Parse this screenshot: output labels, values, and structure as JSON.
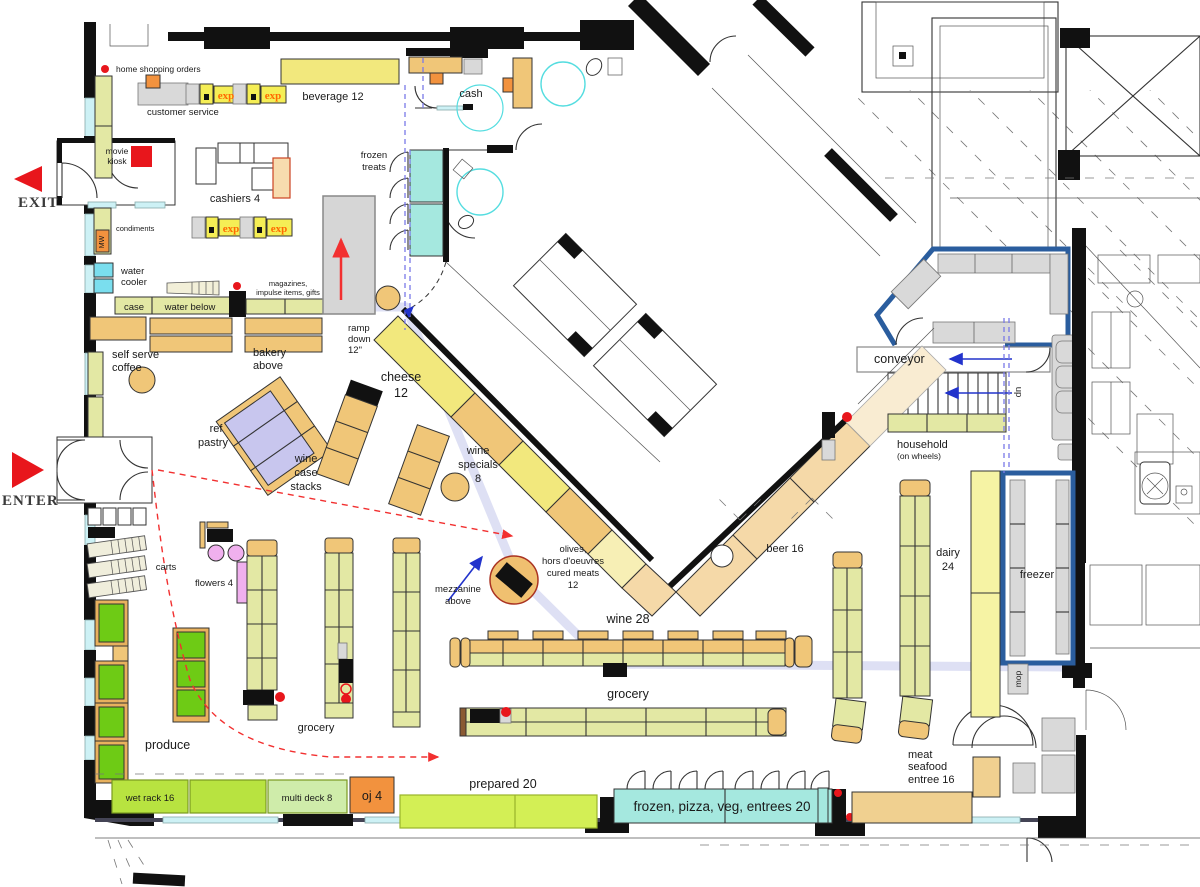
{
  "title": "grocery store floor plan",
  "colors": {
    "shelf_green": "#e3e8a4",
    "tan": "#f0c678",
    "beer_tan": "#f5d9a8",
    "yellow": "#f2e87d",
    "dairy_yellow": "#f6f3a4",
    "cyan_case": "#a5e8df",
    "window_cyan": "#cdf1f5",
    "produce_green": "#6ecb15",
    "wet_rack_green": "#b8e340",
    "multi_deck_green": "#cfecaa",
    "orange": "#f2923e",
    "lavender": "#c8c6ee",
    "pink": "#f0b0ee",
    "red": "#e8161c",
    "blue_wall": "#2a5d9e",
    "lease_line_blue": "#7a7ae8",
    "path_lavender": "#d3d6f0",
    "ramp_gray": "#d6d6d6",
    "exp_yellow": "#f5ee55",
    "exp_text_orange": "#ff6a00"
  },
  "labels": {
    "exit": "EXIT",
    "enter": "ENTER",
    "home_shopping_orders": "home shopping orders",
    "customer_service": "customer service",
    "exp": "exp",
    "beverage": "beverage 12",
    "cash": "cash",
    "movie_kiosk": [
      "movie",
      "kiosk"
    ],
    "cashiers": "cashiers 4",
    "frozen_treats": [
      "frozen",
      "treats"
    ],
    "condiments": "condiments",
    "mw": "MW",
    "water_cooler": [
      "water",
      "cooler"
    ],
    "case": "case",
    "water_below": "water below",
    "magazines": [
      "magazines,",
      "impulse items, gifts"
    ],
    "ramp": [
      "ramp",
      "down",
      "12\""
    ],
    "self_serve_coffee": [
      "self serve",
      "coffee"
    ],
    "bakery_above": [
      "bakery",
      "above"
    ],
    "ref_pastry": [
      "ref",
      "pastry"
    ],
    "wine_case_stacks": [
      "wine",
      "case",
      "stacks"
    ],
    "cheese": [
      "cheese",
      "12"
    ],
    "wine_specials": [
      "wine",
      "specials",
      "8"
    ],
    "carts": "carts",
    "flowers": "flowers 4",
    "olives": [
      "olives,",
      "hors d'oeuvres",
      "cured meats",
      "12"
    ],
    "mezzanine": [
      "mezzanine",
      "above"
    ],
    "conveyor": "conveyor",
    "up": "up",
    "household": [
      "household",
      "(on wheels)"
    ],
    "beer": "beer 16",
    "dairy": [
      "dairy",
      "24"
    ],
    "freezer": "freezer",
    "mop": "mop",
    "wine_run": "wine 28",
    "grocery_run": "grocery",
    "grocery_aisles": "grocery",
    "produce": "produce",
    "wet_rack": "wet rack 16",
    "multi_deck": "multi deck 8",
    "oj": "oj 4",
    "prepared": "prepared 20",
    "frozen_pizza": "frozen, pizza, veg, entrees 20",
    "meat": [
      "meat",
      "seafood",
      "entree 16"
    ]
  }
}
